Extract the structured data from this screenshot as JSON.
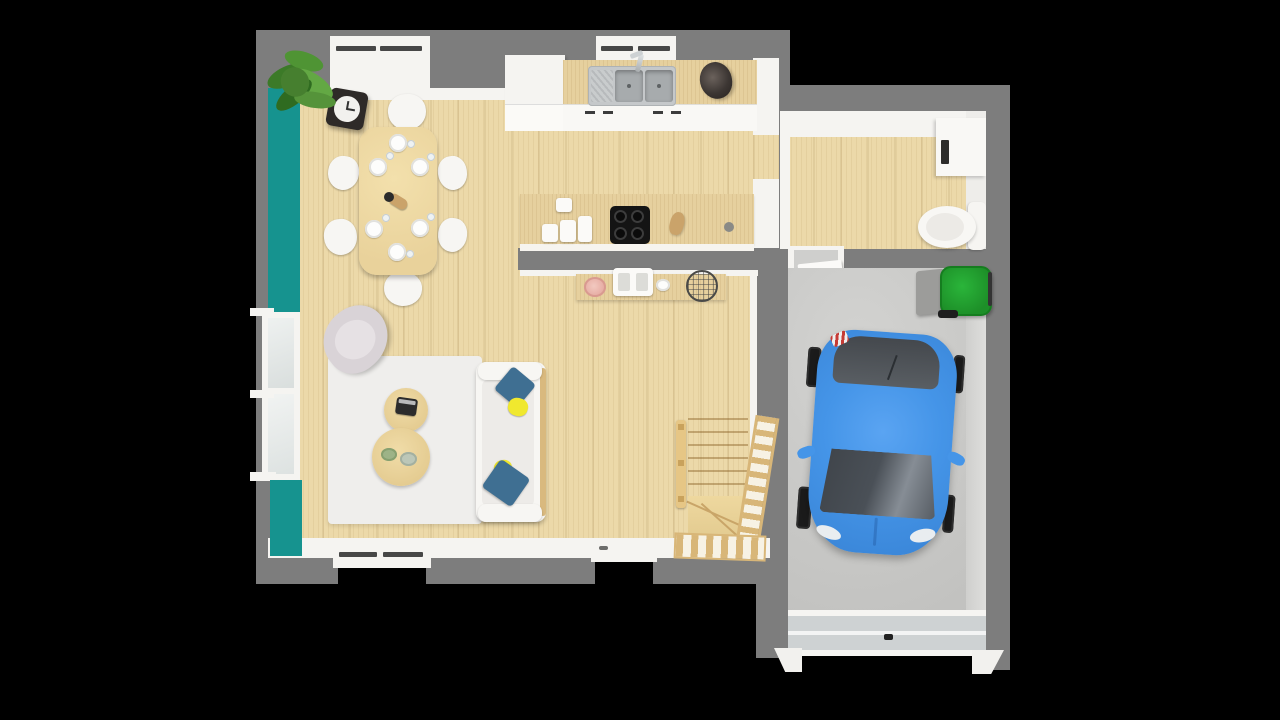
{
  "scene": {
    "type": "3d-floorplan-render",
    "description": "Top-down 3D rendered floor plan of a house: open-plan living, dining and kitchen area with teal accent wall, wooden winder staircase, utility room with toilet, and a garage containing a blue car and a green wheelie bin on a concrete floor",
    "background": "black"
  },
  "colors": {
    "background": "#000000",
    "wall": "#7d7d7d",
    "wall_light": "#f5f4f1",
    "accent_teal": "#16938f",
    "floor_wood": "#ecd9a9",
    "counter_wood": "#e6d09e",
    "garage_floor": "#c8c8c6",
    "garage_door": "#ced2d3",
    "rug": "#efeeec",
    "furniture_white": "#f7f6f3",
    "pillow_blue": "#3f6f92",
    "pillow_yellow": "#f0e82e",
    "car_blue": "#4595e8",
    "car_glass": "#4a4f55",
    "bin_green": "#21a12d",
    "stair_wood": "#ead193",
    "stair_rail": "#d8b678",
    "plant_green": "#4f8f35",
    "clock_frame": "#2e2a28",
    "sink_steel": "#c5c8ca",
    "cooktop_black": "#141414",
    "bowl_pink": "#e5a9a0",
    "armchair_gray": "#d9d3d7"
  },
  "house": {
    "rooms": [
      {
        "name": "Open-plan living, dining and kitchen",
        "floor": "light wood planks"
      },
      {
        "name": "Utility room with toilet",
        "floor": "light wood planks"
      },
      {
        "name": "Garage",
        "floor": "concrete"
      }
    ],
    "accent_wall": "teal painted left wall of living area",
    "dining": {
      "chairs": 6,
      "place_settings": 6
    },
    "kitchen_items": [
      "tall cabinet",
      "counter with double sink and faucet",
      "dark basket",
      "island with 4-burner cooktop",
      "canisters",
      "sideboard with fruit bowl, espresso machine and wire basket"
    ],
    "living_items": [
      "wall clock",
      "potted plant",
      "armchair",
      "white rug",
      "small round coffee table with camera",
      "large round coffee table with two bowls",
      "white sofa with blue and yellow cushions"
    ],
    "stairs": "wooden winder staircase with railings",
    "utility_items": [
      "white appliance cabinet",
      "toilet"
    ],
    "garage_items": [
      "blue hatchback car",
      "green wheelie bin",
      "sectional garage door"
    ]
  }
}
